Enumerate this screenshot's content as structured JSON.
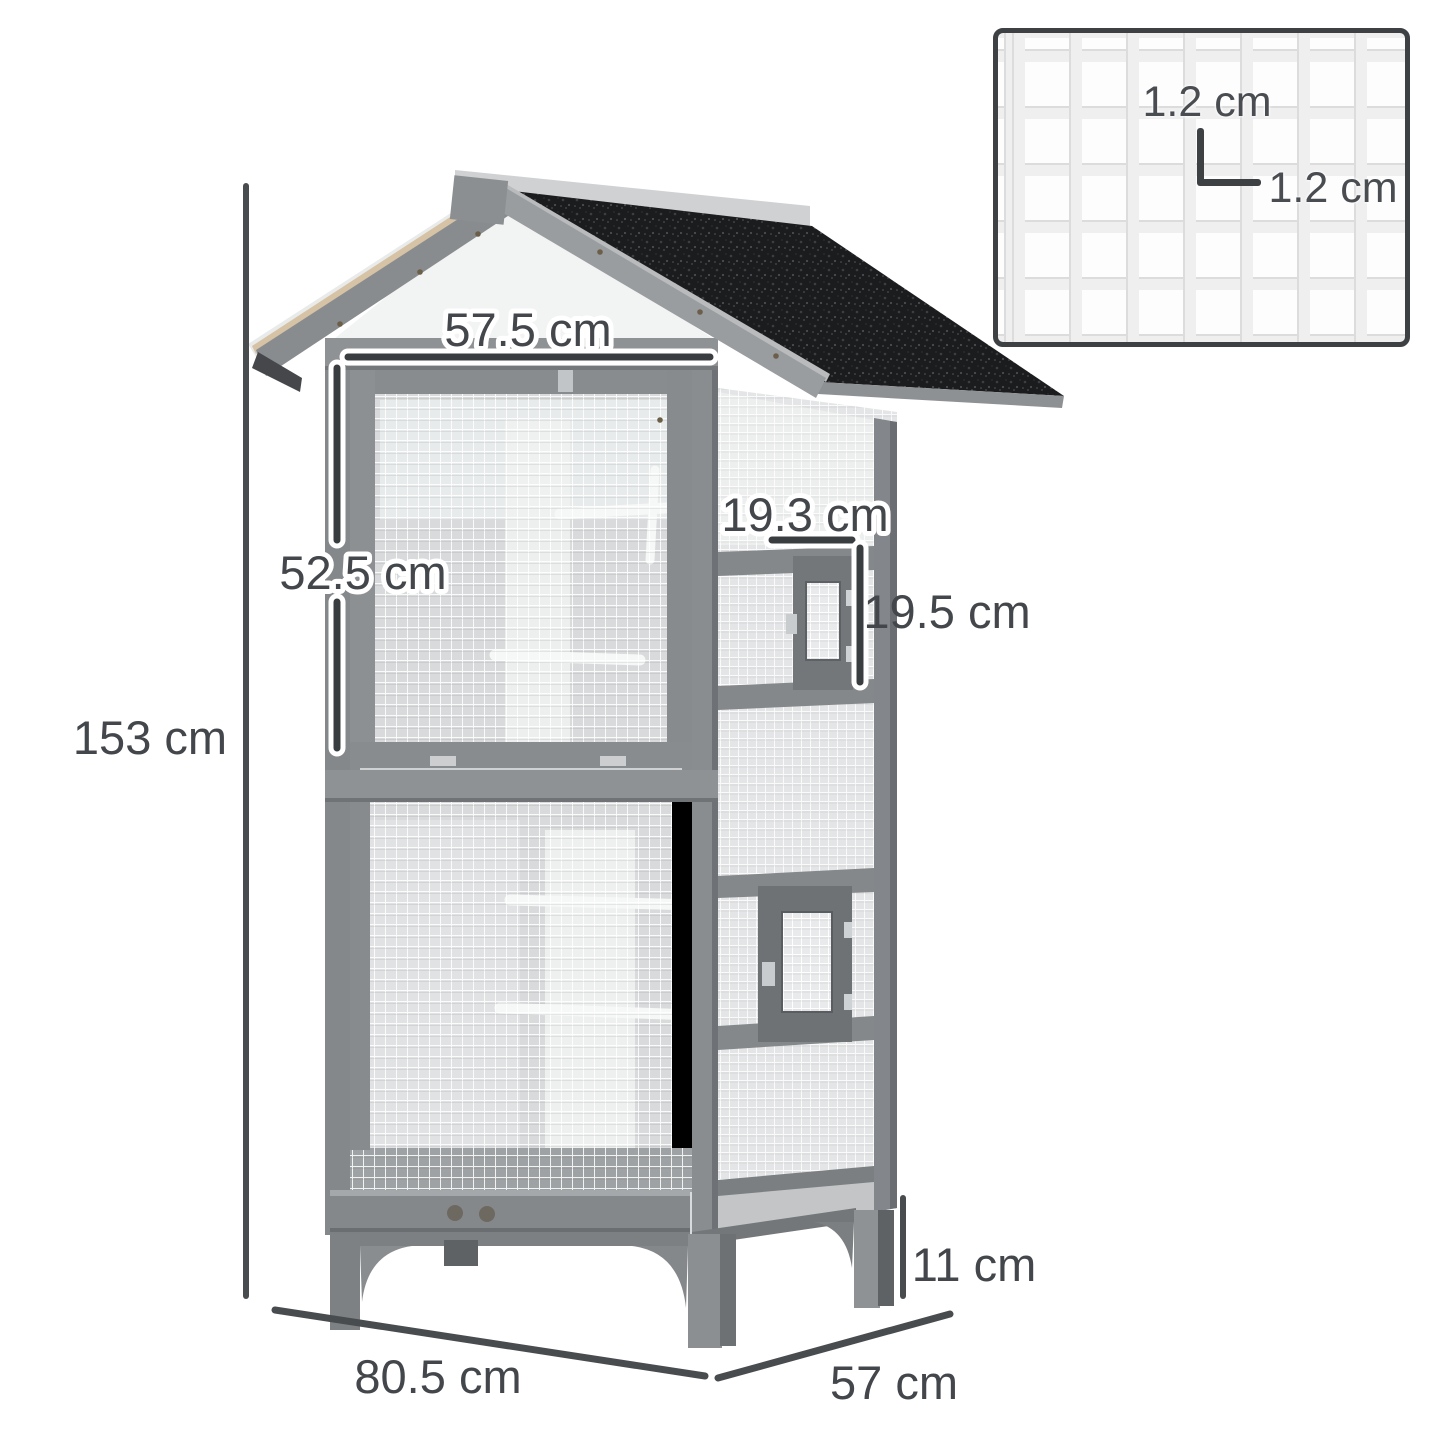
{
  "diagram": {
    "type": "product-dimension-diagram",
    "product_name": "Wooden outdoor bird aviary cage with asphalt roof",
    "dimension_labels": {
      "total_height": "153 cm",
      "top_front_width": "57.5 cm",
      "front_door_height": "52.5 cm",
      "side_door_width": "19.3 cm",
      "side_door_height": "19.5 cm",
      "ground_clearance": "11 cm",
      "base_width": "80.5 cm",
      "base_depth": "57 cm"
    },
    "mesh_inset": {
      "cell_height": "1.2 cm",
      "cell_width": "1.2 cm"
    },
    "colors": {
      "dimension_line": "#494c4f",
      "label_text": "#43464a",
      "roof_asphalt": "#1b1c1e",
      "wood_frame": "#8d9093",
      "trim_tan": "#d6c2a4",
      "mesh_light": "#e3e5e6",
      "background": "#ffffff"
    }
  }
}
